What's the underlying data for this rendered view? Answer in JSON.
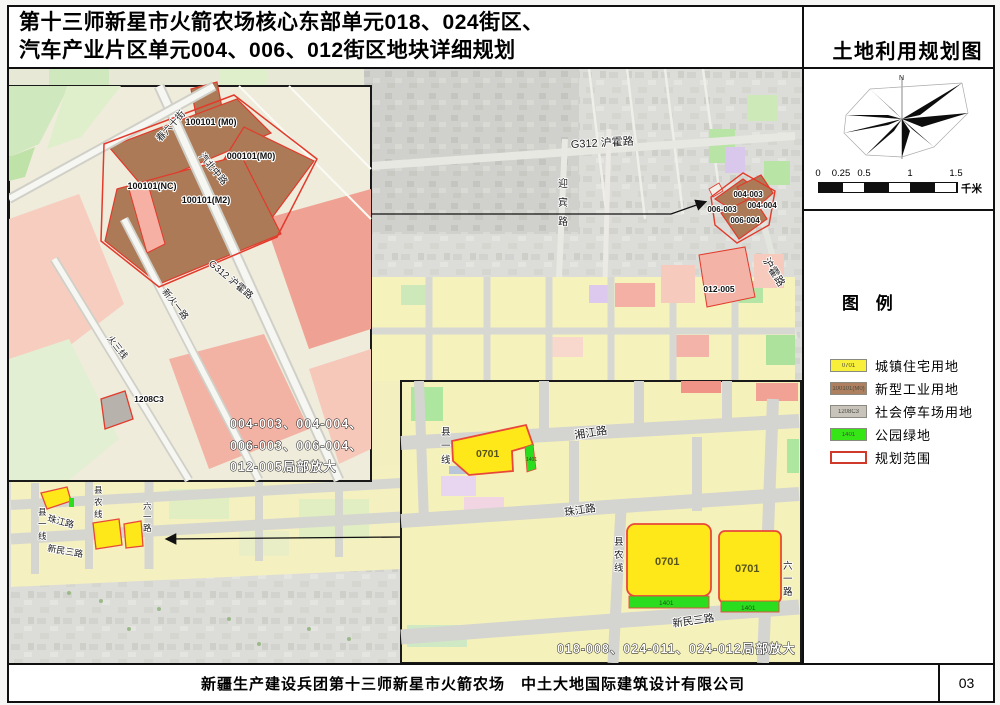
{
  "page": {
    "title_line1": "第十三师新星市火箭农场核心东部单元018、024街区、",
    "title_line2": "汽车产业片区单元004、006、012街区地块详细规划",
    "map_title": "土地利用规划图",
    "footer_text": "新疆生产建设兵团第十三师新星市火箭农场　中土大地国际建筑设计有限公司",
    "page_number": "03"
  },
  "compass": {
    "north": "N"
  },
  "scale_bar": {
    "ticks": [
      "0",
      "0.25",
      "0.5",
      "1",
      "1.5"
    ],
    "unit": "千米"
  },
  "legend": {
    "title": "图 例",
    "items": [
      {
        "code": "0701",
        "label": "城镇住宅用地",
        "color": "#f7ef3a"
      },
      {
        "code": "100101(M0)",
        "label": "新型工业用地",
        "color": "#ae8060"
      },
      {
        "code": "1208C3",
        "label": "社会停车场用地",
        "color": "#c8c4bc"
      },
      {
        "code": "1401",
        "label": "公园绿地",
        "color": "#35e515"
      },
      {
        "code": "",
        "label": "规划范围",
        "color": "#ffffff",
        "border": "#cf3a2a"
      }
    ]
  },
  "colors": {
    "residential_yellow": "#ffe81a",
    "industrial_brown": "#ac7a57",
    "parking_gray": "#b7b3ac",
    "park_green": "#2ade1f",
    "boundary_red": "#e23a2b",
    "farmland_yellow": "#f6f2bb"
  },
  "main_map": {
    "g312": "G312 沪霍路",
    "yingbin": "迎宾路",
    "huhuo": "沪霍路",
    "parcels": {
      "p004_003": "004-003",
      "p004_004": "004-004",
      "p006_003": "006-003",
      "p006_004": "006-004",
      "p012_005": "012-005"
    },
    "streets": {
      "xianyi": "县一线",
      "xiannong": "县农线",
      "liuyi": "六一路",
      "zhujiang": "珠江路",
      "xinmin": "新民三路"
    }
  },
  "inset_left": {
    "roads": {
      "chun": "春六十街",
      "qibei": "汽北中路",
      "g312": "G312 沪霍路",
      "xinhuo": "新火一路",
      "huosan": "火三线"
    },
    "parcels": {
      "m0a": "100101 (M0)",
      "m0b": "000101(M0)",
      "nc": "100101(NC)",
      "m2": "100101(M2)",
      "gray": "1208C3"
    },
    "caption1": "004-003、004-004、",
    "caption2": "006-003、006-004、",
    "caption3": "012-005局部放大"
  },
  "inset_right": {
    "roads": {
      "xiangjiang": "湘江路",
      "zhujiang": "珠江路",
      "xinmin": "新民三路",
      "xianyi": "县一线",
      "xiannong": "县农线",
      "liuyi": "六一路"
    },
    "res_code": "0701",
    "green_code": "1401",
    "caption": "018-008、024-011、024-012局部放大"
  }
}
